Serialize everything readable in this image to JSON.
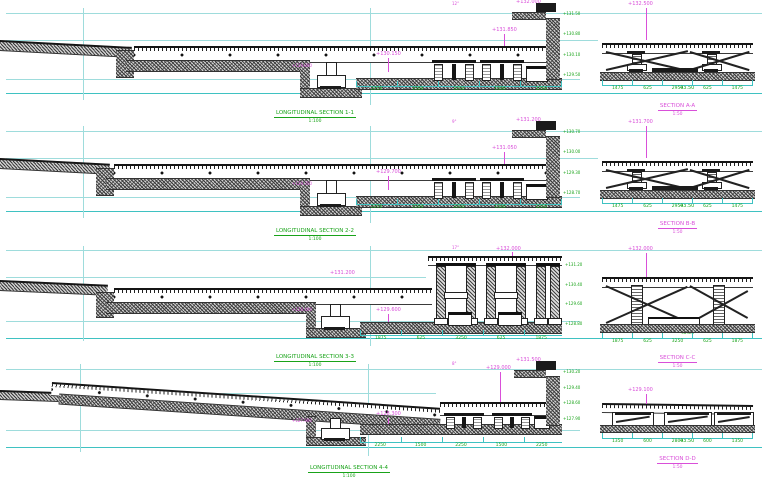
{
  "palette": {
    "grid_cyan": "#9edcdc",
    "dim_cyan": "#3fc2c2",
    "dim_green": "#19a319",
    "label_magenta": "#d94fd9",
    "ink": "#1b1b1b",
    "paper": "#ffffff"
  },
  "rows": [
    {
      "caption": "LONGITUDINAL SECTION 1-1",
      "scale": "1:100",
      "wall_elev": "+132.000",
      "bent_elev": "+131.850",
      "mid_elev": "+130.150",
      "pit_elev": "+129.800",
      "angle_note": "12°",
      "total_dim": "43.50",
      "side_elevs": [
        "+131.50",
        "+130.80",
        "+130.10",
        "+129.50"
      ],
      "dims": [
        "2250",
        "1500",
        "2250",
        "1500",
        "2250"
      ],
      "xsec": {
        "elev": "+132.500",
        "caption": "SECTION A-A",
        "scale": "1:50",
        "dims": [
          "1475",
          "625",
          "2950",
          "625",
          "1475"
        ]
      }
    },
    {
      "caption": "LONGITUDINAL SECTION 2-2",
      "scale": "1:100",
      "wall_elev": "+131.200",
      "bent_elev": "+131.050",
      "mid_elev": "+129.700",
      "pit_elev": "+129.350",
      "angle_note": "9°",
      "total_dim": "43.50",
      "side_elevs": [
        "+130.70",
        "+130.00",
        "+129.30",
        "+128.70"
      ],
      "dims": [
        "2250",
        "1500",
        "2250",
        "1500",
        "2250"
      ],
      "xsec": {
        "elev": "+131.700",
        "caption": "SECTION B-B",
        "scale": "1:50",
        "dims": [
          "1475",
          "625",
          "2950",
          "625",
          "1475"
        ]
      }
    },
    {
      "caption": "LONGITUDINAL SECTION 3-3",
      "scale": "1:100",
      "wall_elev": "+132.000",
      "bent_elev": "+131.200",
      "mid_elev": "+129.600",
      "pit_elev": "+128.400",
      "angle_note": "17°",
      "total_dim": "43.50",
      "side_elevs": [
        "+131.20",
        "+130.40",
        "+129.60",
        "+128.80"
      ],
      "dims": [
        "1875",
        "625",
        "3250",
        "625",
        "1875"
      ],
      "xsec": {
        "elev": "+132.000",
        "caption": "SECTION C-C",
        "scale": "1:50",
        "dims": [
          "1875",
          "625",
          "3250",
          "625",
          "1875"
        ]
      }
    },
    {
      "caption": "LONGITUDINAL SECTION 4-4",
      "scale": "1:100",
      "wall_elev": "+131.500",
      "bent_elev": "+129.000",
      "mid_elev": "+128.300",
      "pit_elev": "+127.900",
      "angle_note": "8°",
      "total_dim": "43.50",
      "side_elevs": [
        "+130.20",
        "+129.40",
        "+128.60",
        "+127.90"
      ],
      "dims": [
        "2250",
        "1500",
        "2250",
        "1500",
        "2250"
      ],
      "xsec": {
        "elev": "+129.100",
        "caption": "SECTION D-D",
        "scale": "1:50",
        "dims": [
          "1350",
          "600",
          "2800",
          "600",
          "1350"
        ]
      }
    }
  ]
}
